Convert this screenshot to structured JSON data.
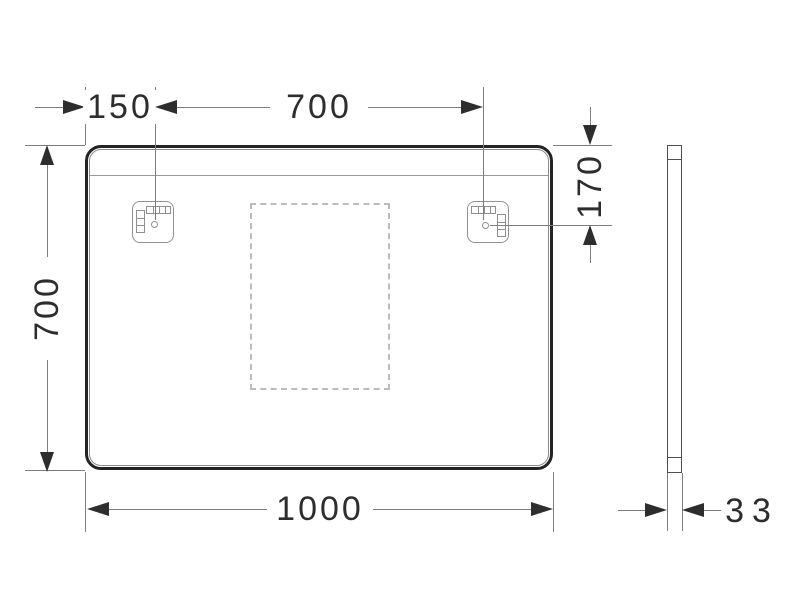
{
  "diagram": {
    "type": "technical-drawing",
    "subject": "wall-mirror dimensional drawing, front elevation and side profile",
    "units": "mm",
    "labels": {
      "bracket_offset": "150",
      "bracket_spacing": "700",
      "overall_height": "700",
      "bracket_top_offset": "170",
      "overall_width": "1000",
      "depth": "33"
    },
    "colors": {
      "background": "#ffffff",
      "outline_dark": "#242424",
      "arrow_and_text": "#2d2d2d",
      "dimension_line": "#7d7d7d",
      "bracket_line": "#909090",
      "dashed_zone": "#bcbcbc"
    },
    "views": {
      "front": "mirror front with two mounting brackets and dashed light/sensor zone",
      "side": "mirror edge profile, depth 33"
    }
  }
}
